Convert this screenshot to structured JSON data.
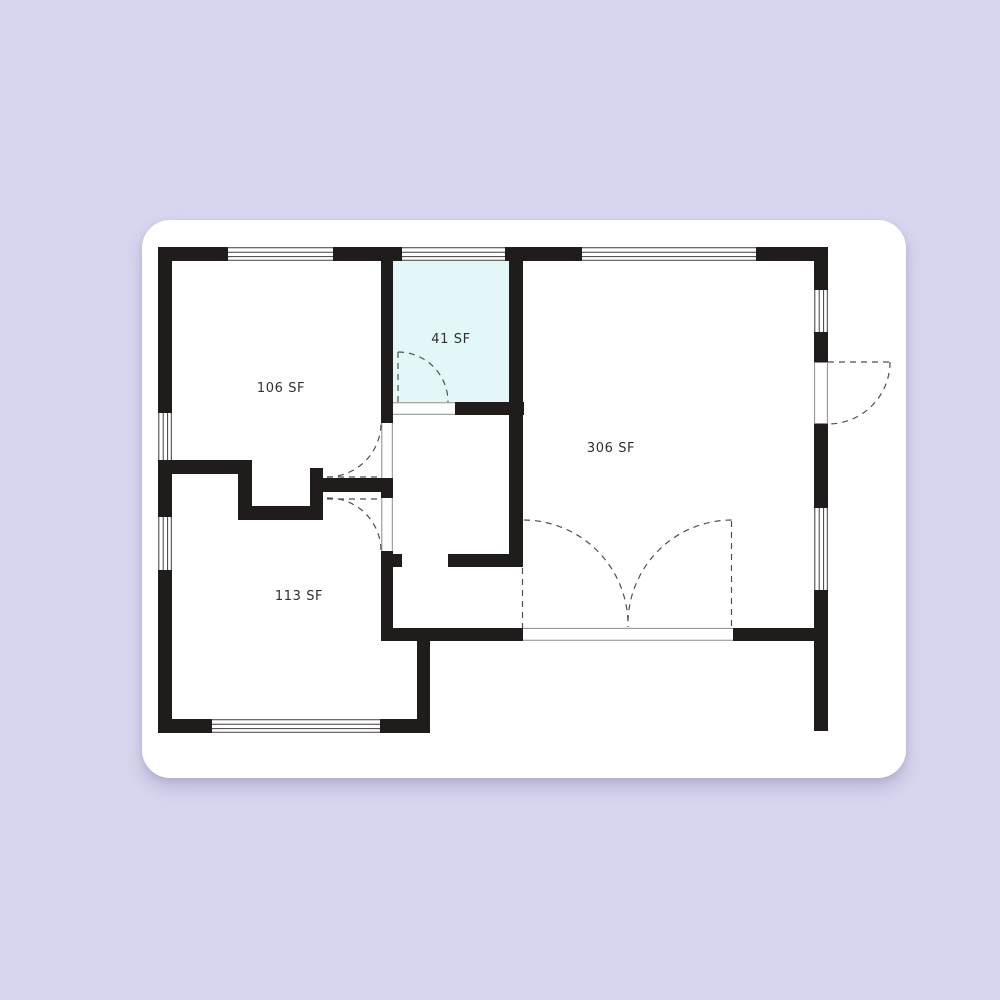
{
  "colors": {
    "page_background": "#d8d6ef",
    "card_background": "#ffffff",
    "wall": "#1f1c1b",
    "highlight_room_fill": "#e3f6f8"
  },
  "floor_plan": {
    "rooms": [
      {
        "id": "room-106",
        "label": "106 SF",
        "area_sf": 106,
        "highlighted": false
      },
      {
        "id": "room-41",
        "label": "41 SF",
        "area_sf": 41,
        "highlighted": true
      },
      {
        "id": "room-306",
        "label": "306 SF",
        "area_sf": 306,
        "highlighted": false
      },
      {
        "id": "room-113",
        "label": "113 SF",
        "area_sf": 113,
        "highlighted": false
      }
    ]
  }
}
